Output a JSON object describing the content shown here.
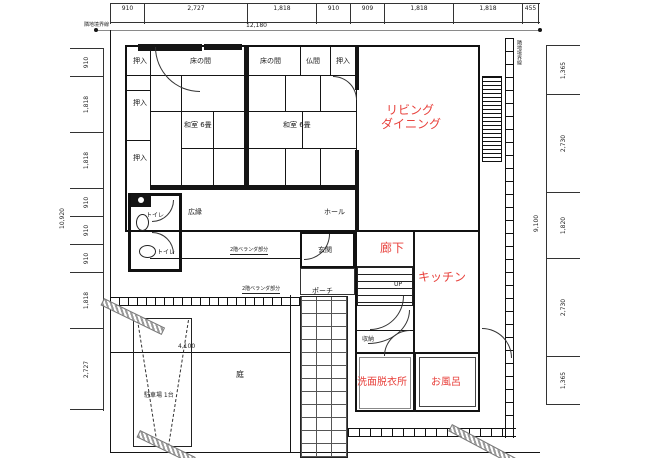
{
  "drawing": {
    "type": "japanese-house-floor-plan",
    "colors": {
      "room_label_red": "#e8423d",
      "line_black": "#151515",
      "boundary_gray": "#8a8a8a"
    }
  },
  "dimensions": {
    "top": {
      "overall": "12,180",
      "segments": [
        "910",
        "2,727",
        "1,818",
        "910",
        "909",
        "1,818",
        "1,818",
        "455"
      ]
    },
    "left": {
      "overall": "10,920",
      "segments": [
        "910",
        "1,818",
        "1,818",
        "910",
        "910",
        "910",
        "1,818",
        "2,727"
      ]
    },
    "right": {
      "overall": "9,100",
      "segments": [
        "1,365",
        "2,730",
        "1,820",
        "2,730",
        "1,365"
      ]
    },
    "garden_width": "4,100"
  },
  "boundary": {
    "top_label": "隣地境界線",
    "right_label": "隣地境界線"
  },
  "rooms": {
    "oshiire1": "押入",
    "oshiire2": "押入",
    "oshiire3": "押入",
    "tokonoma1": "床の間",
    "tokonoma2": "床の間",
    "butsuma": "仏間",
    "oshiire_top": "押入",
    "washitsu1": "和室 6畳",
    "washitsu2": "和室 6畳",
    "hiroen": "広縁",
    "hall": "ホール",
    "toilet1": "トイレ",
    "toilet2": "トイレ",
    "genkan": "玄関",
    "porch": "ポーチ",
    "living_line1": "リビング",
    "living_line2": "ダイニング",
    "corridor": "廊下",
    "kitchen": "キッチン",
    "washroom": "洗面脱衣所",
    "bath": "お風呂",
    "storage": "収納",
    "up": "UP",
    "garden": "庭",
    "parking": "駐車場 1台",
    "veranda_note1": "2階ベランダ部分",
    "veranda_note2": "2階ベランダ部分"
  }
}
